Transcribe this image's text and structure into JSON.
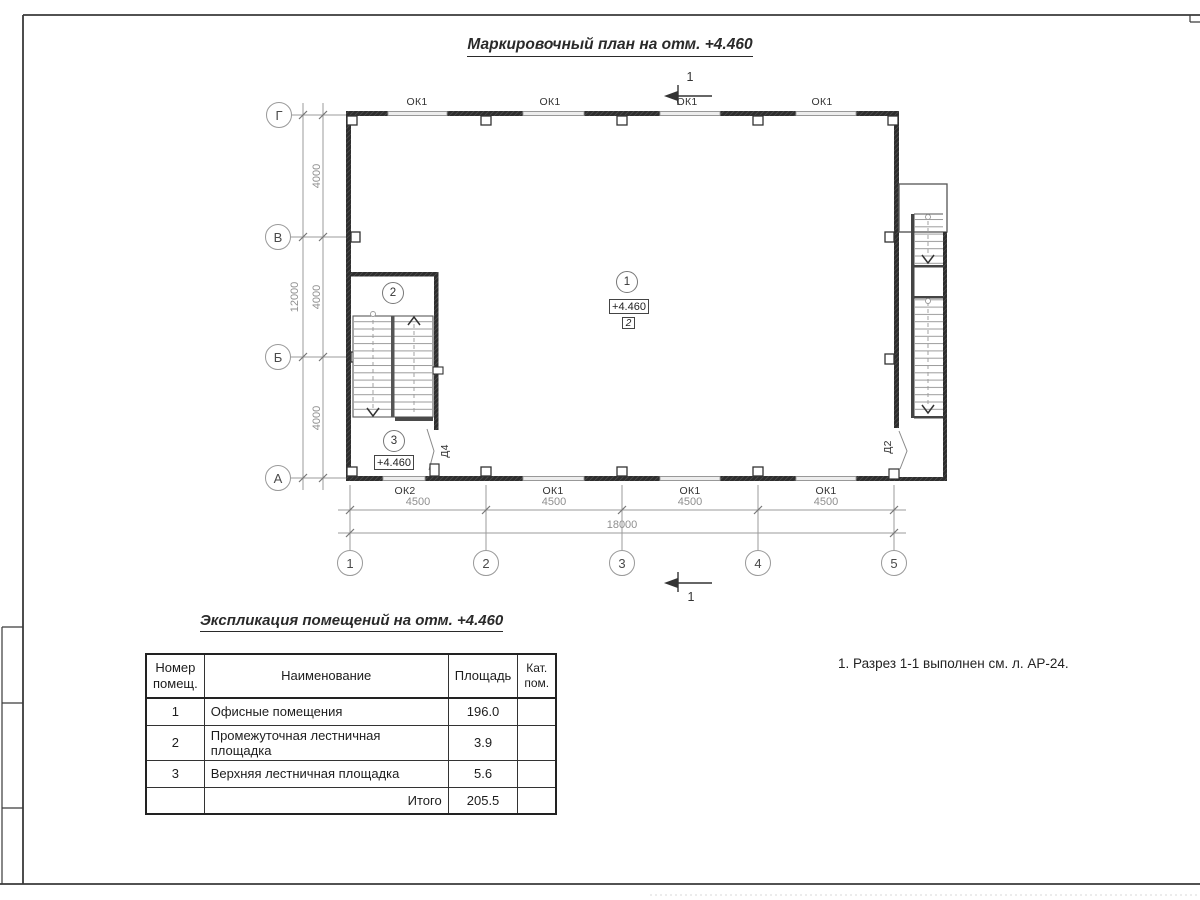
{
  "drawing": {
    "title": "Маркировочный план на отм. +4.460",
    "note": "1. Разрез 1-1 выполнен см. л. АР-24.",
    "section_label": "1",
    "axes_cols": [
      "1",
      "2",
      "3",
      "4",
      "5"
    ],
    "axes_rows": [
      "Г",
      "В",
      "Б",
      "А"
    ],
    "dims": {
      "col_segments": [
        "4500",
        "4500",
        "4500",
        "4500"
      ],
      "col_total": "18000",
      "row_segments": [
        "4000",
        "4000",
        "4000"
      ],
      "row_total": "12000"
    },
    "windows_top": [
      "ОК1",
      "ОК1",
      "ОК1",
      "ОК1"
    ],
    "windows_bottom": [
      "ОК2",
      "ОК1",
      "ОК1",
      "ОК1"
    ],
    "door_left": "Д4",
    "door_right": "Д2",
    "room1": {
      "num": "1",
      "elev": "+4.460",
      "cat": "2"
    },
    "room2": {
      "num": "2"
    },
    "room3": {
      "num": "3",
      "elev": "+4.460"
    }
  },
  "schedule": {
    "title": "Экспликация помещений на отм. +4.460",
    "col_number": "Номер помещ.",
    "col_name": "Наименование",
    "col_area": "Площадь",
    "col_cat": "Кат. пом.",
    "rows": [
      {
        "num": "1",
        "name": "Офисные помещения",
        "area": "196.0",
        "cat": ""
      },
      {
        "num": "2",
        "name": "Промежуточная лестничная площадка",
        "area": "3.9",
        "cat": ""
      },
      {
        "num": "3",
        "name": "Верхняя лестничная площадка",
        "area": "5.6",
        "cat": ""
      }
    ],
    "total_label": "Итого",
    "total_area": "205.5"
  }
}
